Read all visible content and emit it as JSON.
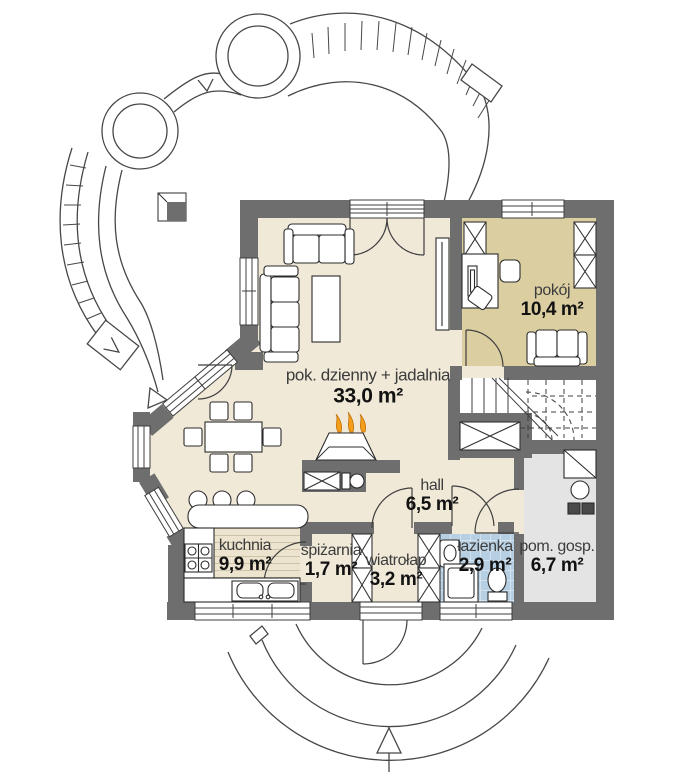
{
  "plan_title": "parter-floor-plan",
  "rooms": [
    {
      "name": "pok. dzienny + jadalnia",
      "area": "33,0 m²"
    },
    {
      "name": "pokój",
      "area": "10,4 m²"
    },
    {
      "name": "hall",
      "area": "6,5 m²"
    },
    {
      "name": "kuchnia",
      "area": "9,9 m²"
    },
    {
      "name": "spiżarnia",
      "area": "1,7 m²"
    },
    {
      "name": "wiatrołap",
      "area": "3,2 m²"
    },
    {
      "name": "łazienka",
      "area": "2,9 m²"
    },
    {
      "name": "pom. gosp.",
      "area": "6,7 m²"
    }
  ],
  "colors": {
    "wall": "#6e6e6e",
    "floor_main": "#f0e9d8",
    "floor_room": "#dbcfa2",
    "floor_bath": "#b7cfe2",
    "floor_utility": "#e4e4e4",
    "floor_kitchen": "#ece4cf",
    "flame": "#f59e1b",
    "line": "#3f3f3f"
  }
}
